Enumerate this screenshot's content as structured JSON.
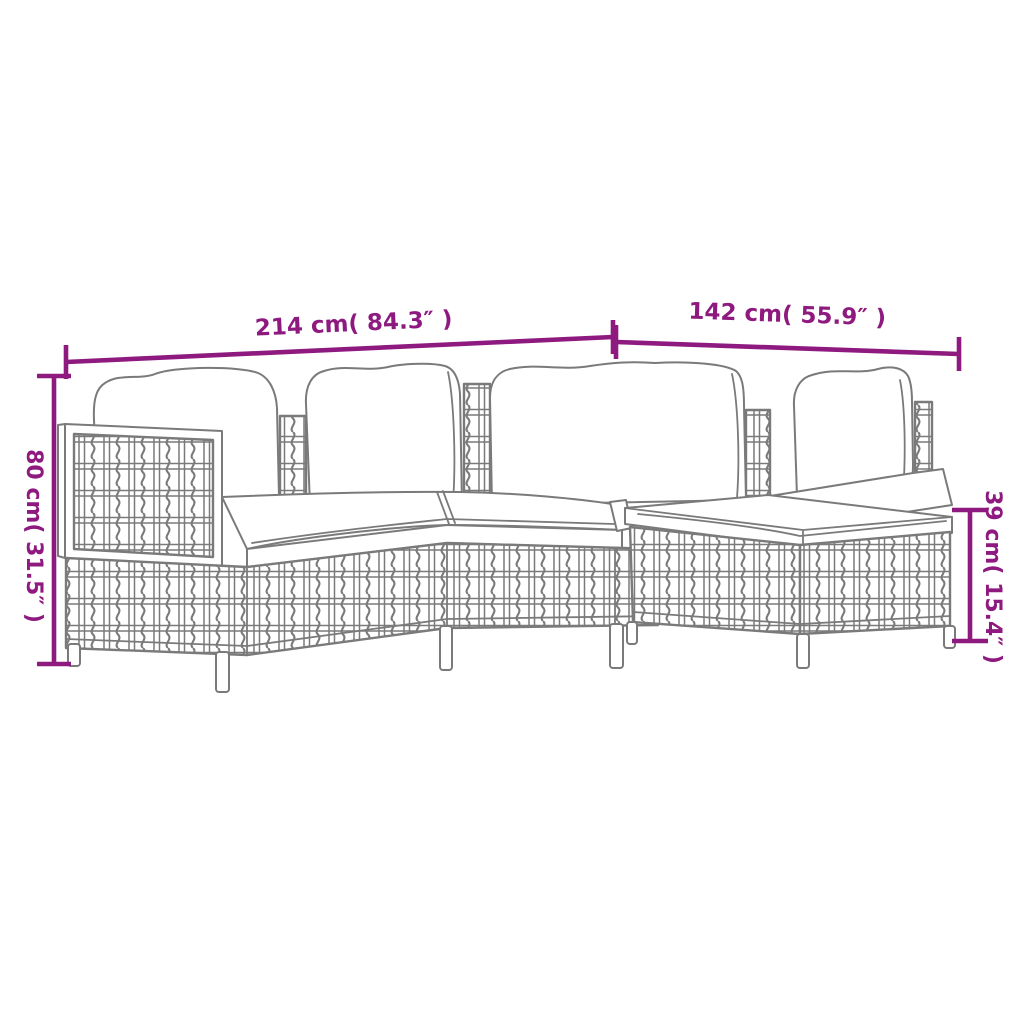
{
  "page": {
    "background": "#ffffff"
  },
  "diagram": {
    "subject": "poly-rattan-garden-lounge-set-line-drawing",
    "accent_color": "#8e1a80",
    "line_color": "#7a7a7a",
    "dimensions": {
      "total_width": {
        "label": "214 cm( 84.3″ )"
      },
      "depth": {
        "label": "142 cm( 55.9″ )"
      },
      "back_height": {
        "label": "80 cm( 31.5″ )"
      },
      "seat_height": {
        "label": "39 cm( 15.4″ )"
      }
    }
  }
}
